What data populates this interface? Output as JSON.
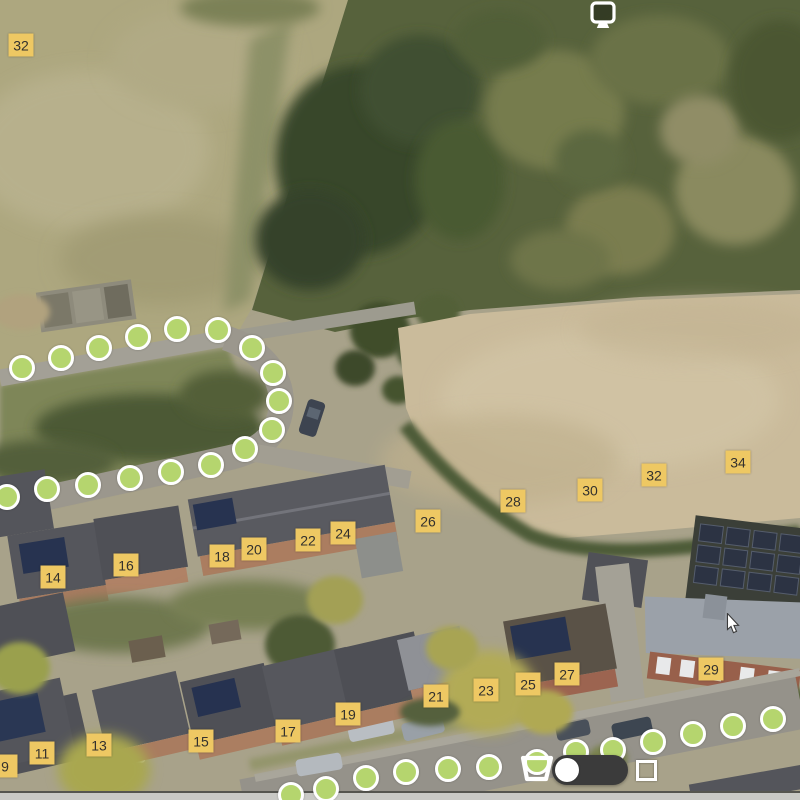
{
  "map_overlay": {
    "marker_style": {
      "fill": "#eec863",
      "text_color": "#33312e"
    },
    "house_number_markers": [
      {
        "label": "32",
        "x": 21,
        "y": 45
      },
      {
        "label": "14",
        "x": 53,
        "y": 577
      },
      {
        "label": "16",
        "x": 126,
        "y": 565
      },
      {
        "label": "18",
        "x": 222,
        "y": 556
      },
      {
        "label": "20",
        "x": 254,
        "y": 549
      },
      {
        "label": "22",
        "x": 308,
        "y": 540
      },
      {
        "label": "24",
        "x": 343,
        "y": 533
      },
      {
        "label": "26",
        "x": 428,
        "y": 521
      },
      {
        "label": "28",
        "x": 513,
        "y": 501
      },
      {
        "label": "30",
        "x": 590,
        "y": 490
      },
      {
        "label": "32",
        "x": 654,
        "y": 475
      },
      {
        "label": "34",
        "x": 738,
        "y": 462
      },
      {
        "label": "9",
        "x": 5,
        "y": 766
      },
      {
        "label": "11",
        "x": 42,
        "y": 753
      },
      {
        "label": "13",
        "x": 99,
        "y": 745
      },
      {
        "label": "15",
        "x": 201,
        "y": 741
      },
      {
        "label": "17",
        "x": 288,
        "y": 731
      },
      {
        "label": "19",
        "x": 348,
        "y": 714
      },
      {
        "label": "21",
        "x": 436,
        "y": 696
      },
      {
        "label": "23",
        "x": 486,
        "y": 690
      },
      {
        "label": "25",
        "x": 528,
        "y": 684
      },
      {
        "label": "27",
        "x": 567,
        "y": 674
      },
      {
        "label": "29",
        "x": 711,
        "y": 669
      }
    ],
    "route_style": {
      "dot_fill": "#b5d56e",
      "dot_border": "#ffffff"
    },
    "route_upper_dots": [
      [
        22,
        368
      ],
      [
        61,
        358
      ],
      [
        99,
        348
      ],
      [
        138,
        337
      ],
      [
        177,
        329
      ],
      [
        218,
        330
      ],
      [
        252,
        348
      ],
      [
        273,
        373
      ],
      [
        279,
        401
      ],
      [
        272,
        430
      ],
      [
        245,
        449
      ],
      [
        211,
        465
      ],
      [
        171,
        472
      ],
      [
        130,
        478
      ],
      [
        88,
        485
      ],
      [
        47,
        489
      ],
      [
        7,
        497
      ]
    ],
    "route_lower_dots": [
      [
        291,
        795
      ],
      [
        326,
        789
      ],
      [
        366,
        778
      ],
      [
        406,
        772
      ],
      [
        448,
        769
      ],
      [
        489,
        767
      ],
      [
        537,
        762
      ],
      [
        576,
        752
      ],
      [
        613,
        750
      ],
      [
        653,
        742
      ],
      [
        693,
        734
      ],
      [
        733,
        726
      ],
      [
        773,
        719
      ]
    ]
  },
  "controls": {
    "top_monitor_icon": "monitor-icon",
    "bottom_bucket_icon": "bucket-icon",
    "view_toggle": {
      "state": "left",
      "track_color": "#3b3b3b",
      "knob_color": "#ffffff"
    },
    "bottom_square_icon": "square-icon"
  },
  "cursor": {
    "x": 726,
    "y": 613
  }
}
